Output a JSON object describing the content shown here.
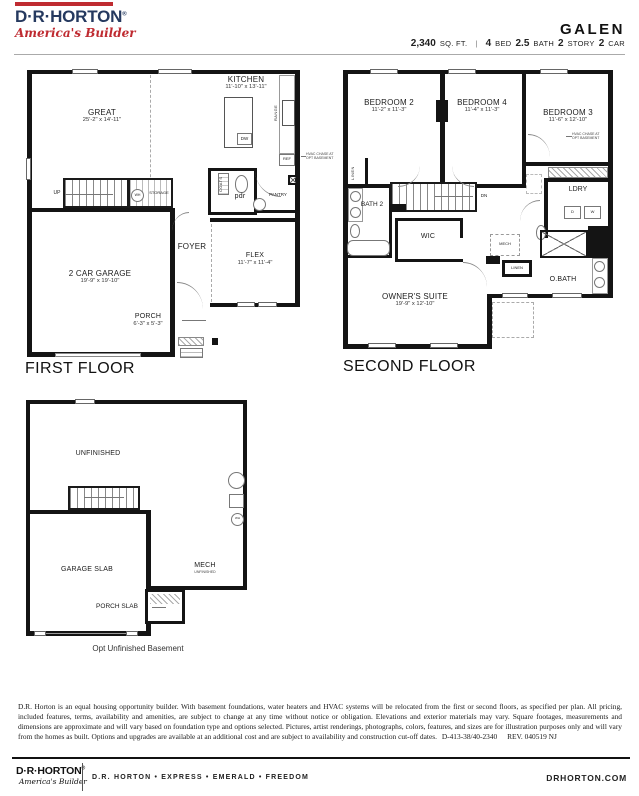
{
  "header": {
    "logo_name": "D·R·HORTON",
    "logo_reg": "®",
    "logo_tagline": "America's Builder",
    "plan_name": "GALEN",
    "separator": "|",
    "specs": [
      {
        "value": "2,340",
        "label": "SQ. FT."
      },
      {
        "value": "4",
        "label": "BED"
      },
      {
        "value": "2.5",
        "label": "BATH"
      },
      {
        "value": "2",
        "label": "STORY"
      },
      {
        "value": "2",
        "label": "CAR"
      }
    ]
  },
  "colors": {
    "navy": "#25395f",
    "red": "#bf2b31",
    "wall": "#141414"
  },
  "first_floor": {
    "title": "FIRST FLOOR",
    "great": {
      "name": "GREAT",
      "dims": "25'-2\" x 14'-11\""
    },
    "kitchen": {
      "name": "KITCHEN",
      "dims": "11'-10\" x 13'-11\""
    },
    "garage": {
      "name": "2 CAR GARAGE",
      "dims": "19'-9\" x 19'-10\""
    },
    "flex": {
      "name": "FLEX",
      "dims": "11'-7\" x 11'-4\""
    },
    "porch": {
      "name": "PORCH",
      "dims": "6'-3\" x 5'-3\""
    },
    "foyer": "FOYER",
    "pdr": "pdr",
    "pantry": "PANTRY",
    "coats": "COATS",
    "up": "UP",
    "wh": "WH",
    "storage": "STORAGE",
    "range": "RANGE",
    "dw": "DW",
    "ref": "REF",
    "hvac_note": "HVAC CHASE AT OPT BASEMENT"
  },
  "second_floor": {
    "title": "SECOND FLOOR",
    "bedroom2": {
      "name": "BEDROOM 2",
      "dims": "11'-2\" x 11'-3\""
    },
    "bedroom4": {
      "name": "BEDROOM 4",
      "dims": "11'-4\" x 11'-3\""
    },
    "bedroom3": {
      "name": "BEDROOM 3",
      "dims": "11'-6\" x 12'-10\""
    },
    "owners_suite": {
      "name": "OWNER'S SUITE",
      "dims": "19'-9\" x 12'-10\""
    },
    "bath2": "BATH 2",
    "wic": "WIC",
    "ldry": "LDRY",
    "obath": "O.BATH",
    "mech": "MECH",
    "linen_left": "LINEN",
    "linen_center": "LINEN",
    "dn": "DN",
    "dryer": "D",
    "washer": "W",
    "hvac_note": "HVAC CHASE AT OPT BASEMENT"
  },
  "basement": {
    "caption": "Opt Unfinished Basement",
    "unfinished": "UNFINISHED",
    "garage_slab": "GARAGE SLAB",
    "mech": "MECH",
    "mech_sub": "UNFINISHED",
    "porch_slab": "PORCH SLAB",
    "wh": "WH"
  },
  "footer": {
    "disclaimer": "D.R. Horton is an equal housing opportunity builder. With basement foundations, water heaters and HVAC systems will be relocated from the first or second floors, as specified per plan. All pricing, included features, terms, availability and amenities, are subject to change at any time without notice or obligation. Elevations and exterior materials may vary. Square footages, measurements and dimensions are approximate and will vary based on foundation type and options selected. Pictures, artist renderings, photographs, colors, features, and sizes are for illustration purposes only and will vary from the homes as built. Options and upgrades are available at an additional cost and are subject to availability and construction cut-off dates.",
    "doc_code": "D-413-38/40-2340",
    "revision": "REV. 040519 NJ"
  },
  "bottom_bar": {
    "logo_name": "D·R·HORTON",
    "logo_reg": "®",
    "logo_tagline": "America's Builder",
    "brands": "D.R. HORTON • EXPRESS • EMERALD • FREEDOM",
    "website": "DRHORTON.COM"
  }
}
